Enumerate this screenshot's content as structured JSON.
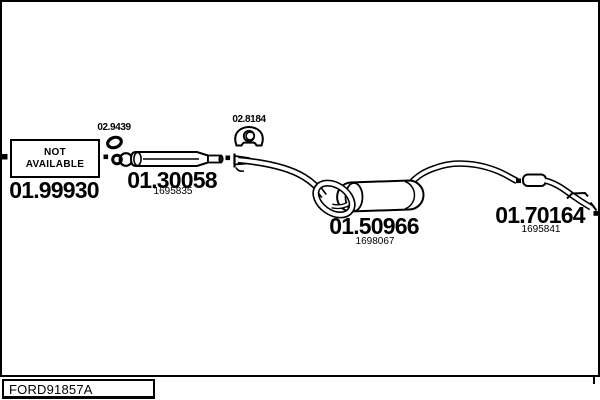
{
  "page": {
    "background": "#ffffff",
    "line_color": "#000000"
  },
  "not_available_box": {
    "line1": "NOT",
    "line2": "AVAILABLE"
  },
  "parts": {
    "front_pipe": {
      "number": "01.99930"
    },
    "clamp_ring": {
      "number": "02.9439"
    },
    "centre_silencer": {
      "number": "01.30058",
      "ref": "1695835"
    },
    "flange_gasket": {
      "number": "02.8184"
    },
    "rear_silencer": {
      "number": "01.50966",
      "ref": "1698067"
    },
    "tail_pipe": {
      "number": "01.70164",
      "ref": "1695841"
    }
  },
  "footer": {
    "code": "FORD91857A"
  }
}
